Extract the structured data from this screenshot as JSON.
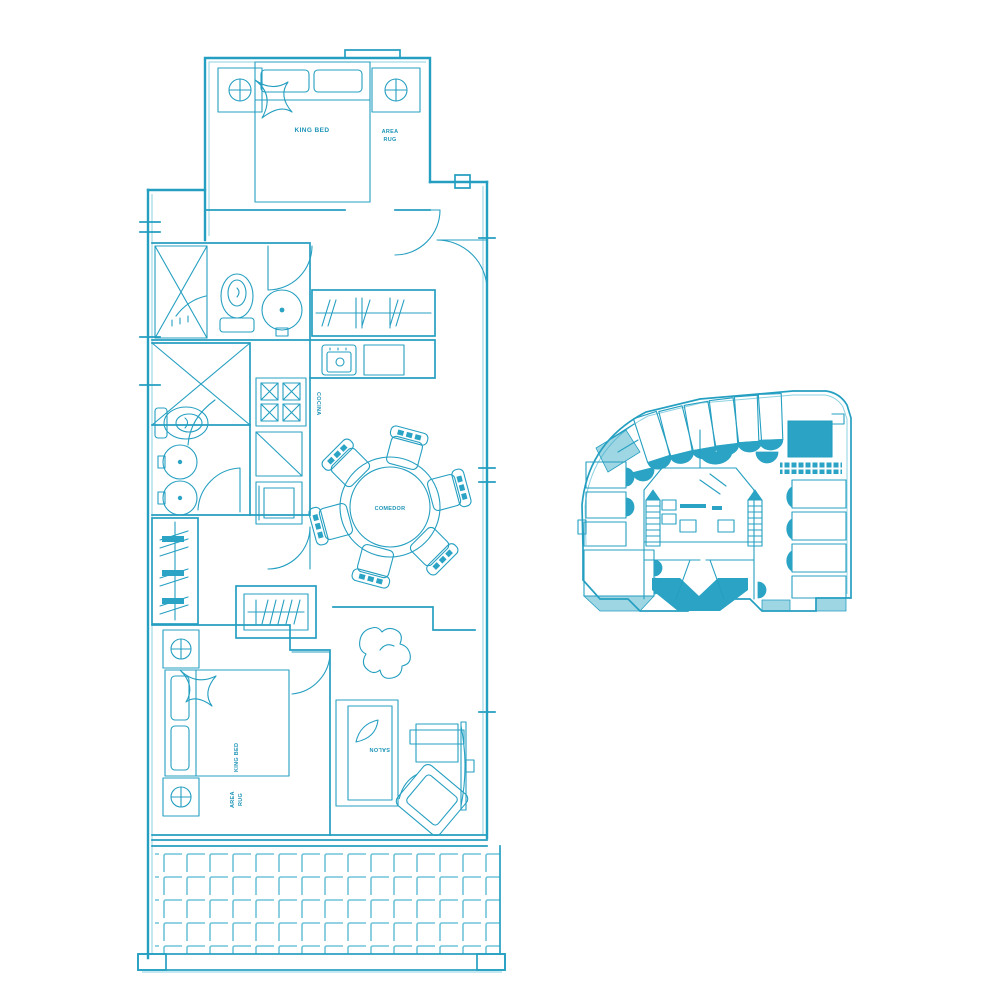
{
  "document": {
    "type": "apartment floor plan drawing",
    "colors": {
      "ink": "#259fc1",
      "ink_light": "#8ed1e2",
      "ink_dark": "#1d94b7",
      "solid_fill": "#2aa3c4",
      "background": "#ffffff"
    }
  },
  "unit_plan": {
    "bedroom_top": {
      "bed_label": "KING BED",
      "rug_line1": "AREA",
      "rug_line2": "RUG"
    },
    "kitchen": {
      "label": "COCINA"
    },
    "dining": {
      "label": "COMEDOR"
    },
    "living": {
      "label": "SALON"
    },
    "bedroom_bottom": {
      "bed_label": "KING BED",
      "rug_line1": "AREA",
      "rug_line2": "RUG"
    }
  },
  "key_plan": {
    "highlighted_unit_color": "#2aa3c4"
  }
}
